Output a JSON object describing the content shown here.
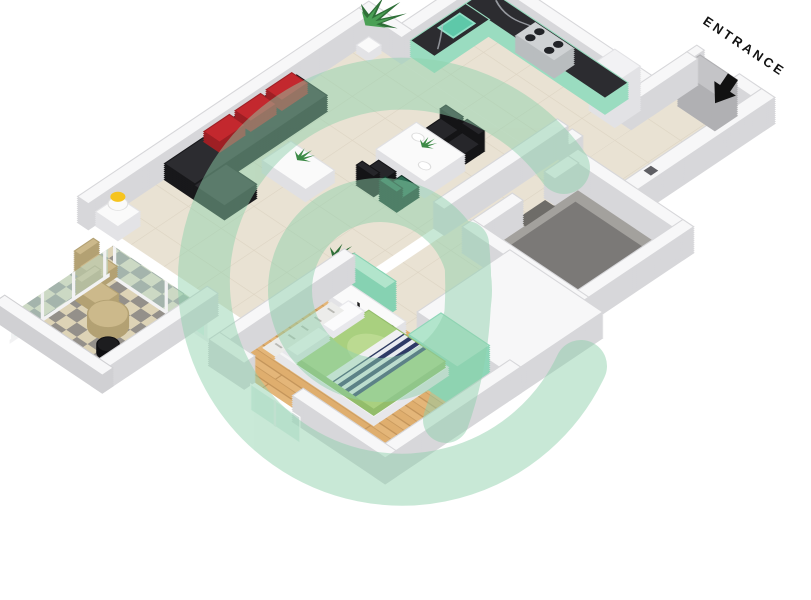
{
  "entrance": {
    "label": "ENTRANCE",
    "arrow_icon": "arrow-down-left"
  },
  "tv": {
    "brand": "@bayut"
  },
  "watermark": {
    "icon": "bayut-at-sign-watermark",
    "color": "#8ed0ab",
    "opacity": 0.48
  },
  "palette": {
    "wall_top": "#f7f7f8",
    "wall_side": "#d7d7da",
    "floor_tile": "#e9e2d3",
    "wood_floor": "#e4b679",
    "bath_floor": "#a3a19d",
    "bath_slab": "#7b7977",
    "mint": "#8fd6b8",
    "mint_light": "#b2e5cc",
    "marble_counter": "#2c2c30",
    "sofa_dark": "#2c2c30",
    "cushion_red": "#c3282e",
    "bed_green": "#a9d07f",
    "glass": "#bee1d5",
    "tan_furniture": "#ccb98b",
    "lamp_yellow": "#f6c41f",
    "plant_green": "#3c8a46",
    "tv_screen": "#0d3527",
    "tv_text": "#79d7a7",
    "entrance_text": "#111111"
  }
}
